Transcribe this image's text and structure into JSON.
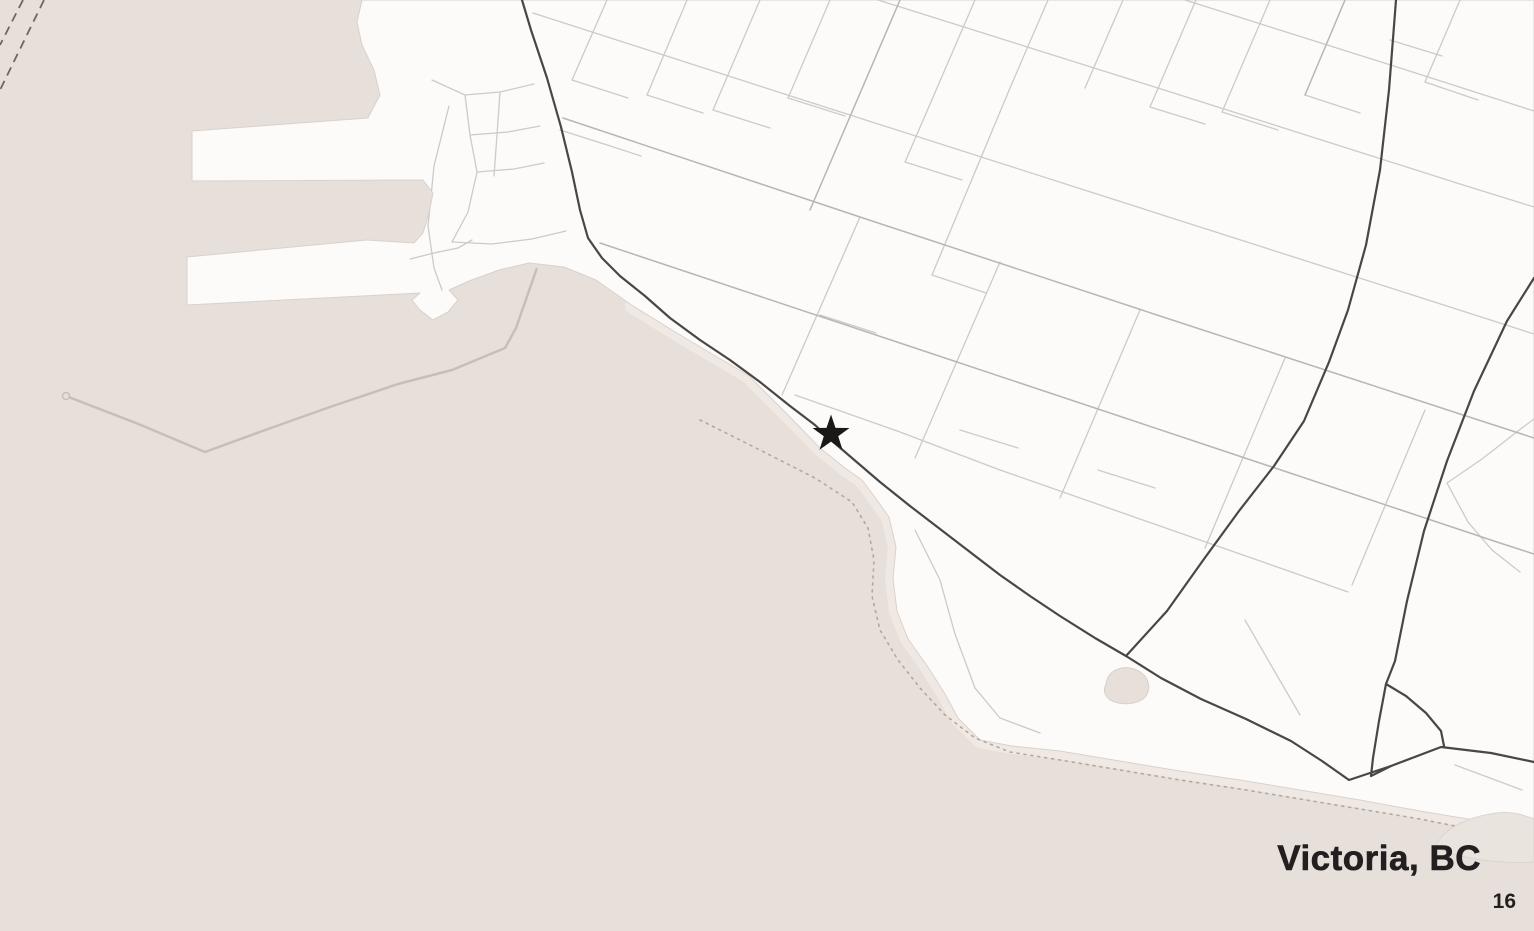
{
  "title": {
    "text": "Victoria, BC"
  },
  "page_number": {
    "text": "16"
  },
  "marker": {
    "shape": "star",
    "x": 831,
    "y": 434,
    "outer_radius": 19.5,
    "inner_radius": 7.6,
    "color": "#1b1918"
  },
  "colors": {
    "water": "#e7dfda",
    "land": "#fcfbfa",
    "coastline": "#d9d2cc",
    "sand": "#f0e9e3",
    "sand_patch": "#eae4df",
    "sand_patch_edge": "#dcd4ce",
    "street_minor": "#cdcac8",
    "street_medium": "#b9b5b2",
    "road_major": "#4b4643",
    "breakwater": "#c6bfb9",
    "ferry_route": "#6e6661",
    "trail": "#b4a79e",
    "pond_fill": "#e7dfda",
    "pond_edge": "#d8d0ca",
    "title_text": "#231f20"
  },
  "map": {
    "land_outline": [
      [
        362,
        0
      ],
      [
        357,
        22
      ],
      [
        362,
        45
      ],
      [
        374,
        70
      ],
      [
        380,
        95
      ],
      [
        371,
        112
      ],
      [
        368,
        118
      ],
      [
        192,
        131
      ],
      [
        192,
        181
      ],
      [
        423,
        180
      ],
      [
        433,
        193
      ],
      [
        429,
        213
      ],
      [
        423,
        233
      ],
      [
        414,
        243
      ],
      [
        367,
        240
      ],
      [
        187,
        257
      ],
      [
        187,
        305
      ],
      [
        420,
        293
      ],
      [
        412,
        300
      ],
      [
        420,
        310
      ],
      [
        433,
        320
      ],
      [
        448,
        312
      ],
      [
        458,
        300
      ],
      [
        449,
        290
      ],
      [
        469,
        281
      ],
      [
        499,
        270
      ],
      [
        529,
        263
      ],
      [
        564,
        267
      ],
      [
        596,
        280
      ],
      [
        633,
        306
      ],
      [
        672,
        330
      ],
      [
        712,
        354
      ],
      [
        748,
        375
      ],
      [
        788,
        415
      ],
      [
        820,
        448
      ],
      [
        845,
        468
      ],
      [
        862,
        480
      ],
      [
        874,
        496
      ],
      [
        889,
        517
      ],
      [
        896,
        547
      ],
      [
        893,
        579
      ],
      [
        897,
        611
      ],
      [
        908,
        639
      ],
      [
        928,
        667
      ],
      [
        945,
        694
      ],
      [
        958,
        718
      ],
      [
        980,
        740
      ],
      [
        1012,
        746
      ],
      [
        1060,
        751
      ],
      [
        1120,
        761
      ],
      [
        1180,
        771
      ],
      [
        1240,
        780
      ],
      [
        1300,
        790
      ],
      [
        1360,
        800
      ],
      [
        1420,
        811
      ],
      [
        1480,
        821
      ],
      [
        1534,
        830
      ],
      [
        1534,
        0
      ]
    ],
    "sand_band": [
      [
        633,
        306
      ],
      [
        672,
        330
      ],
      [
        712,
        354
      ],
      [
        748,
        375
      ],
      [
        788,
        415
      ],
      [
        820,
        448
      ],
      [
        845,
        468
      ],
      [
        862,
        480
      ],
      [
        874,
        496
      ],
      [
        889,
        517
      ],
      [
        896,
        547
      ],
      [
        893,
        579
      ],
      [
        897,
        611
      ],
      [
        908,
        639
      ],
      [
        928,
        667
      ],
      [
        945,
        694
      ],
      [
        958,
        718
      ],
      [
        980,
        740
      ],
      [
        1012,
        746
      ],
      [
        1060,
        751
      ],
      [
        1120,
        761
      ],
      [
        1180,
        771
      ],
      [
        1240,
        780
      ],
      [
        1300,
        790
      ],
      [
        1360,
        800
      ],
      [
        1420,
        811
      ],
      [
        1480,
        821
      ],
      [
        1534,
        830
      ]
    ],
    "sand_patch_path": "M1437,843 C1448,826 1468,818 1490,814 C1510,810 1524,815 1534,819 L1534,862 C1508,864 1470,860 1450,853 C1440,849 1433,847 1437,843 Z",
    "pond_path": "M1106,684 C1108,670 1122,665 1134,669 C1148,674 1152,686 1146,696 C1138,706 1116,706 1108,698 C1103,693 1104,688 1106,684 Z",
    "ferry_routes": [
      [
        [
          23,
          0
        ],
        [
          0,
          45
        ]
      ],
      [
        [
          44,
          0
        ],
        [
          0,
          90
        ]
      ]
    ],
    "breakwater": [
      [
        537,
        268
      ],
      [
        516,
        328
      ],
      [
        505,
        348
      ],
      [
        452,
        370
      ],
      [
        398,
        384
      ],
      [
        330,
        407
      ],
      [
        268,
        429
      ],
      [
        205,
        452
      ],
      [
        136,
        423
      ],
      [
        66,
        396
      ]
    ],
    "breakwater_end": {
      "x": 66,
      "y": 396,
      "r": 3.5
    },
    "trail": [
      [
        700,
        420
      ],
      [
        760,
        450
      ],
      [
        815,
        478
      ],
      [
        852,
        502
      ],
      [
        868,
        528
      ],
      [
        874,
        560
      ],
      [
        872,
        596
      ],
      [
        880,
        630
      ],
      [
        898,
        660
      ],
      [
        920,
        688
      ],
      [
        945,
        715
      ],
      [
        975,
        738
      ],
      [
        1010,
        752
      ],
      [
        1060,
        760
      ],
      [
        1120,
        770
      ],
      [
        1180,
        780
      ],
      [
        1240,
        789
      ],
      [
        1300,
        799
      ],
      [
        1360,
        809
      ],
      [
        1420,
        819
      ],
      [
        1480,
        831
      ],
      [
        1534,
        842
      ]
    ],
    "roads_major": [
      [
        [
          522,
          0
        ],
        [
          531,
          30
        ],
        [
          547,
          78
        ],
        [
          561,
          127
        ],
        [
          572,
          172
        ],
        [
          580,
          210
        ],
        [
          588,
          238
        ],
        [
          602,
          258
        ],
        [
          620,
          276
        ],
        [
          645,
          296
        ],
        [
          670,
          318
        ],
        [
          700,
          340
        ],
        [
          730,
          360
        ],
        [
          760,
          382
        ],
        [
          790,
          406
        ],
        [
          815,
          425
        ],
        [
          831,
          440
        ],
        [
          852,
          458
        ],
        [
          880,
          482
        ],
        [
          910,
          506
        ],
        [
          940,
          529
        ],
        [
          970,
          552
        ],
        [
          1000,
          575
        ],
        [
          1030,
          596
        ],
        [
          1060,
          616
        ],
        [
          1095,
          638
        ],
        [
          1126,
          656
        ],
        [
          1161,
          678
        ],
        [
          1201,
          699
        ],
        [
          1246,
          719
        ],
        [
          1291,
          741
        ],
        [
          1322,
          761
        ],
        [
          1349,
          780
        ],
        [
          1391,
          766
        ],
        [
          1441,
          747
        ],
        [
          1491,
          753
        ],
        [
          1534,
          762
        ]
      ],
      [
        [
          1396,
          0
        ],
        [
          1389,
          90
        ],
        [
          1380,
          170
        ],
        [
          1366,
          245
        ],
        [
          1348,
          310
        ],
        [
          1329,
          362
        ],
        [
          1304,
          421
        ],
        [
          1274,
          466
        ],
        [
          1239,
          511
        ],
        [
          1204,
          559
        ],
        [
          1167,
          611
        ],
        [
          1126,
          656
        ]
      ],
      [
        [
          1534,
          278
        ],
        [
          1507,
          321
        ],
        [
          1474,
          391
        ],
        [
          1447,
          461
        ],
        [
          1424,
          531
        ],
        [
          1407,
          601
        ],
        [
          1395,
          661
        ],
        [
          1386,
          684
        ],
        [
          1379,
          721
        ],
        [
          1373,
          758
        ],
        [
          1371,
          776
        ],
        [
          1391,
          766
        ]
      ],
      [
        [
          1386,
          684
        ],
        [
          1406,
          696
        ],
        [
          1426,
          713
        ],
        [
          1441,
          731
        ],
        [
          1444,
          746
        ]
      ]
    ],
    "streets_medium": [
      [
        [
          563,
          118
        ],
        [
          860,
          217
        ],
        [
          1160,
          316
        ],
        [
          1460,
          414
        ],
        [
          1534,
          438
        ]
      ],
      [
        [
          600,
          243
        ],
        [
          900,
          343
        ],
        [
          1200,
          443
        ],
        [
          1500,
          543
        ],
        [
          1534,
          554
        ]
      ],
      [
        [
          900,
          0
        ],
        [
          810,
          210
        ]
      ],
      [
        [
          1345,
          0
        ],
        [
          1305,
          95
        ]
      ]
    ],
    "streets_minor": [
      [
        [
          533,
          13
        ],
        [
          800,
          99
        ],
        [
          1100,
          195
        ],
        [
          1400,
          291
        ],
        [
          1534,
          334
        ]
      ],
      [
        [
          878,
          0
        ],
        [
          1180,
          95
        ],
        [
          1460,
          184
        ],
        [
          1534,
          207
        ]
      ],
      [
        [
          1185,
          0
        ],
        [
          1400,
          68
        ],
        [
          1534,
          111
        ]
      ],
      [
        [
          795,
          395
        ],
        [
          900,
          432
        ],
        [
          1000,
          470
        ],
        [
          1100,
          505
        ],
        [
          1200,
          540
        ],
        [
          1300,
          575
        ],
        [
          1348,
          592
        ]
      ],
      [
        [
          915,
          530
        ],
        [
          940,
          580
        ],
        [
          955,
          634
        ],
        [
          975,
          688
        ],
        [
          1000,
          718
        ],
        [
          1040,
          733
        ]
      ],
      [
        [
          607,
          0
        ],
        [
          572,
          80
        ]
      ],
      [
        [
          687,
          0
        ],
        [
          647,
          95
        ]
      ],
      [
        [
          760,
          0
        ],
        [
          713,
          110
        ]
      ],
      [
        [
          830,
          0
        ],
        [
          788,
          98
        ]
      ],
      [
        [
          975,
          0
        ],
        [
          905,
          162
        ]
      ],
      [
        [
          1048,
          0
        ],
        [
          1010,
          88
        ]
      ],
      [
        [
          1123,
          0
        ],
        [
          1085,
          88
        ]
      ],
      [
        [
          1010,
          88
        ],
        [
          932,
          275
        ]
      ],
      [
        [
          1196,
          0
        ],
        [
          1150,
          107
        ]
      ],
      [
        [
          1270,
          0
        ],
        [
          1222,
          112
        ]
      ],
      [
        [
          1460,
          0
        ],
        [
          1425,
          82
        ]
      ],
      [
        [
          860,
          217
        ],
        [
          782,
          395
        ]
      ],
      [
        [
          1000,
          262
        ],
        [
          915,
          458
        ]
      ],
      [
        [
          1140,
          310
        ],
        [
          1060,
          498
        ]
      ],
      [
        [
          1285,
          358
        ],
        [
          1205,
          548
        ]
      ],
      [
        [
          1425,
          410
        ],
        [
          1352,
          585
        ]
      ],
      [
        [
          572,
          80
        ],
        [
          628,
          98
        ]
      ],
      [
        [
          647,
          95
        ],
        [
          703,
          113
        ]
      ],
      [
        [
          713,
          110
        ],
        [
          770,
          128
        ]
      ],
      [
        [
          788,
          98
        ],
        [
          845,
          116
        ]
      ],
      [
        [
          905,
          162
        ],
        [
          962,
          180
        ]
      ],
      [
        [
          1150,
          107
        ],
        [
          1205,
          124
        ]
      ],
      [
        [
          1222,
          112
        ],
        [
          1278,
          130
        ]
      ],
      [
        [
          820,
          315
        ],
        [
          876,
          333
        ]
      ],
      [
        [
          960,
          430
        ],
        [
          1018,
          448
        ]
      ],
      [
        [
          1098,
          470
        ],
        [
          1155,
          488
        ]
      ],
      [
        [
          932,
          275
        ],
        [
          986,
          293
        ]
      ],
      [
        [
          1305,
          95
        ],
        [
          1360,
          113
        ]
      ],
      [
        [
          1425,
          82
        ],
        [
          1478,
          100
        ]
      ],
      [
        [
          1390,
          40
        ],
        [
          1442,
          56
        ]
      ],
      [
        [
          432,
          80
        ],
        [
          465,
          95
        ],
        [
          500,
          92
        ],
        [
          534,
          84
        ]
      ],
      [
        [
          465,
          95
        ],
        [
          470,
          135
        ],
        [
          477,
          172
        ],
        [
          468,
          212
        ],
        [
          452,
          242
        ]
      ],
      [
        [
          470,
          135
        ],
        [
          508,
          132
        ],
        [
          540,
          126
        ]
      ],
      [
        [
          477,
          172
        ],
        [
          514,
          169
        ],
        [
          544,
          163
        ]
      ],
      [
        [
          452,
          242
        ],
        [
          492,
          244
        ],
        [
          532,
          239
        ],
        [
          566,
          231
        ]
      ],
      [
        [
          449,
          106
        ],
        [
          434,
          166
        ],
        [
          428,
          226
        ],
        [
          434,
          268
        ],
        [
          442,
          290
        ]
      ],
      [
        [
          410,
          259
        ],
        [
          434,
          253
        ],
        [
          458,
          248
        ],
        [
          472,
          240
        ]
      ],
      [
        [
          500,
          92
        ],
        [
          497,
          135
        ],
        [
          494,
          176
        ]
      ],
      [
        [
          560,
          130
        ],
        [
          601,
          143
        ],
        [
          641,
          156
        ]
      ],
      [
        [
          1447,
          483
        ],
        [
          1482,
          459
        ],
        [
          1518,
          431
        ],
        [
          1534,
          419
        ]
      ],
      [
        [
          1447,
          483
        ],
        [
          1468,
          522
        ],
        [
          1492,
          550
        ],
        [
          1520,
          572
        ]
      ],
      [
        [
          1245,
          620
        ],
        [
          1275,
          672
        ],
        [
          1300,
          715
        ]
      ],
      [
        [
          1455,
          765
        ],
        [
          1490,
          778
        ],
        [
          1522,
          790
        ]
      ]
    ]
  }
}
